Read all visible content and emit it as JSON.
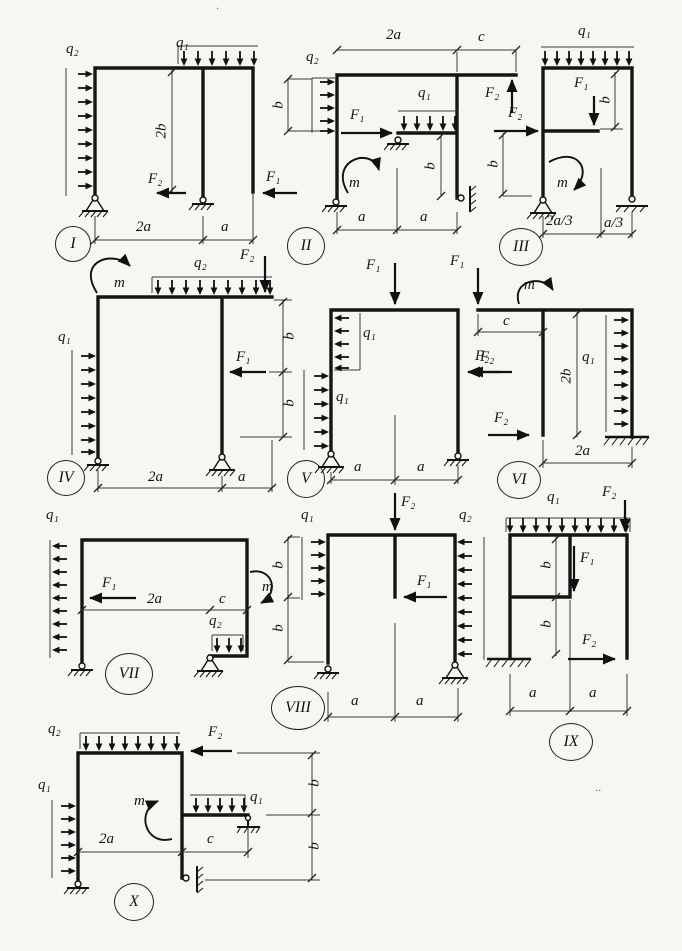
{
  "colors": {
    "ink": "#1a1a1a",
    "paper": "#f7f6f2"
  },
  "artifacts": {
    "dot_top": "·",
    "dot_right": "··"
  },
  "diagrams": {
    "I": {
      "num": "I",
      "q2": "q₂",
      "q1": "q₁",
      "F2": "F₂",
      "F1": "F₁",
      "dim_2b": "2b",
      "dim_2a": "2a",
      "dim_a": "a"
    },
    "II": {
      "num": "II",
      "q2": "q₂",
      "q1": "q₁",
      "F1": "F₁",
      "F2": "F₂",
      "m": "m",
      "dim_2a": "2a",
      "dim_c": "c",
      "dim_b1": "b",
      "dim_b2": "b",
      "dim_a1": "a",
      "dim_a2": "a"
    },
    "III": {
      "num": "III",
      "q1": "q₁",
      "F1": "F₁",
      "F2": "F₂",
      "m": "m",
      "dim_b1": "b",
      "dim_b2": "b",
      "dim_2a3": "2a/3",
      "dim_a3": "a/3"
    },
    "IV": {
      "num": "IV",
      "m": "m",
      "q2": "q₂",
      "q1": "q₁",
      "F1": "F₁",
      "F2": "F₂",
      "dim_b1": "b",
      "dim_b2": "b",
      "dim_2a": "2a",
      "dim_a": "a"
    },
    "V": {
      "num": "V",
      "F1": "F₁",
      "q1_top": "q₁",
      "q1_bottom": "q₁",
      "F2": "F₂",
      "dim_a1": "a",
      "dim_a2": "a"
    },
    "VI": {
      "num": "VI",
      "F1": "F₁",
      "m": "m",
      "q1": "q₁",
      "F2_top": "F₂",
      "F2_bottom": "F₂",
      "dim_c": "c",
      "dim_2b": "2b",
      "dim_2a": "2a"
    },
    "VII": {
      "num": "VII",
      "q1": "q₁",
      "q2": "q₂",
      "F1": "F₁",
      "m": "m",
      "dim_2a": "2a",
      "dim_c": "c"
    },
    "VIII": {
      "num": "VIII",
      "F2": "F₂",
      "F1": "F₁",
      "q1": "q₁",
      "q2": "q₂",
      "dim_b1": "b",
      "dim_b2": "b",
      "dim_a1": "a",
      "dim_a2": "a"
    },
    "IX": {
      "num": "IX",
      "q1": "q₁",
      "F2_top": "F₂",
      "F1": "F₁",
      "F2_bottom": "F₂",
      "dim_b1": "b",
      "dim_b2": "b",
      "dim_a1": "a",
      "dim_a2": "a"
    },
    "X": {
      "num": "X",
      "q2": "q₂",
      "q1_beam": "q₁",
      "q1_column": "q₁",
      "F2": "F₂",
      "m": "m",
      "dim_2a": "2a",
      "dim_c": "c",
      "dim_b1": "b",
      "dim_b2": "b"
    }
  }
}
